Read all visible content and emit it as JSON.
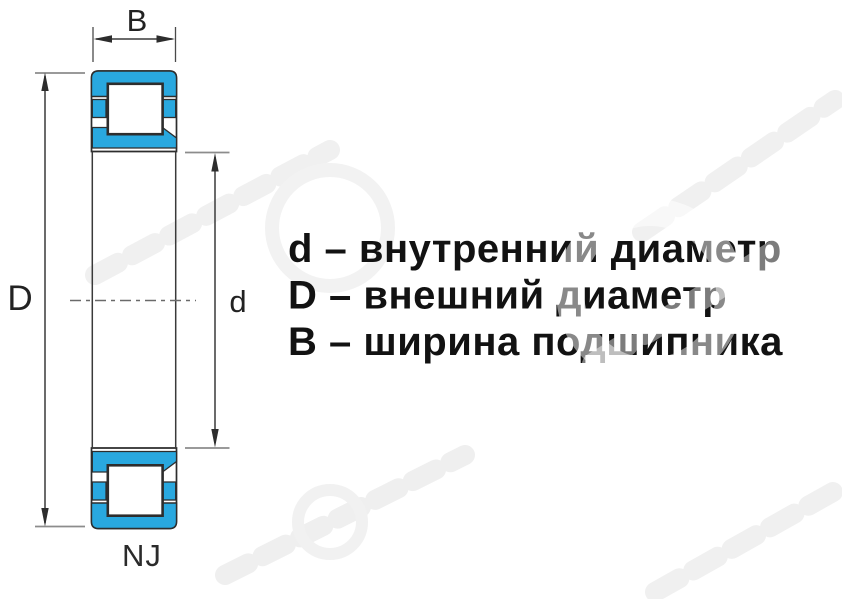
{
  "diagram": {
    "type_label": "NJ",
    "dimensions": {
      "width_symbol": "B",
      "outer_diameter_symbol": "D",
      "inner_diameter_symbol": "d"
    },
    "colors": {
      "ring_fill": "#29A8DF",
      "outline": "#2D2D2D",
      "dimension_line": "#3A3A3A",
      "extension_tick": "#8C8C8C",
      "text": "#121212"
    }
  },
  "legend": {
    "line1": "d – внутренний диаметр",
    "line2": "D – внешний диаметр",
    "line3": "B – ширина подшипника"
  }
}
